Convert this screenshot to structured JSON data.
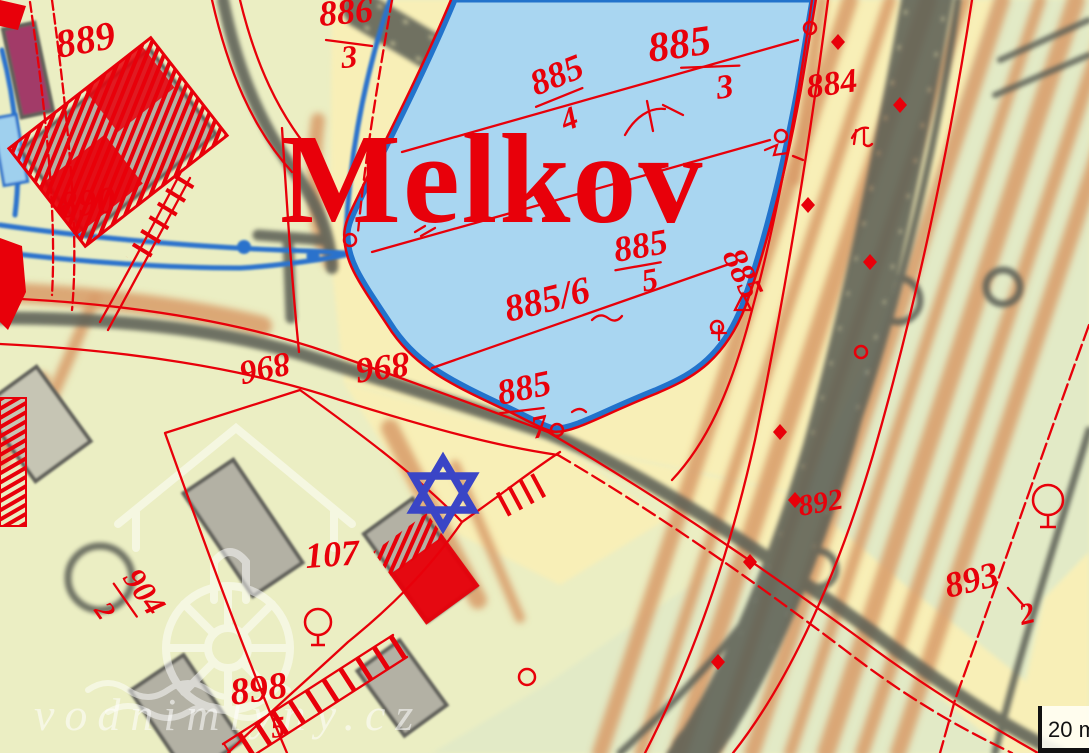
{
  "map": {
    "type": "historical-cadastral-map-overlay",
    "place_name": "Melkov",
    "marker": {
      "shape": "six-pointed-star",
      "color": "#3a45c6"
    },
    "watermark": {
      "text": "vodnimlyny.cz"
    },
    "scale_bar": {
      "label": "20 m"
    },
    "parcel_labels": {
      "p889": "889",
      "p890": "890",
      "p886_3": {
        "num": "886",
        "den": "3"
      },
      "p884": "884",
      "p885_3": {
        "num": "885",
        "den": "3"
      },
      "p885_4": {
        "num": "885",
        "den": "4"
      },
      "p885_5": {
        "num": "885",
        "den": "5"
      },
      "p885_6": "885/6",
      "p885_7": {
        "num": "885",
        "den": "7"
      },
      "p885_edge": "885",
      "p892": "892",
      "p893_2": {
        "num": "893",
        "den": "2"
      },
      "p896_a": "896",
      "p896_b": "896",
      "p898": {
        "num": "898",
        "den": "5"
      },
      "p904_2": {
        "num": "904",
        "den": "2"
      },
      "p107": "107"
    },
    "colors": {
      "red": "#e8000a",
      "lake_fill": "#a9d6f1",
      "lake_border": "#2273cc",
      "marker_blue": "#3a45c6",
      "road_gray": "#5d6057",
      "field_orange": "#d89b68",
      "bg_left": "#ebeec3",
      "bg_right": "#e2eac6",
      "bg_corridor": "#f8efb7",
      "building_gray": "#b3b1a4",
      "magenta": "#a23a68",
      "stream_blue": "#2b72cc"
    }
  }
}
